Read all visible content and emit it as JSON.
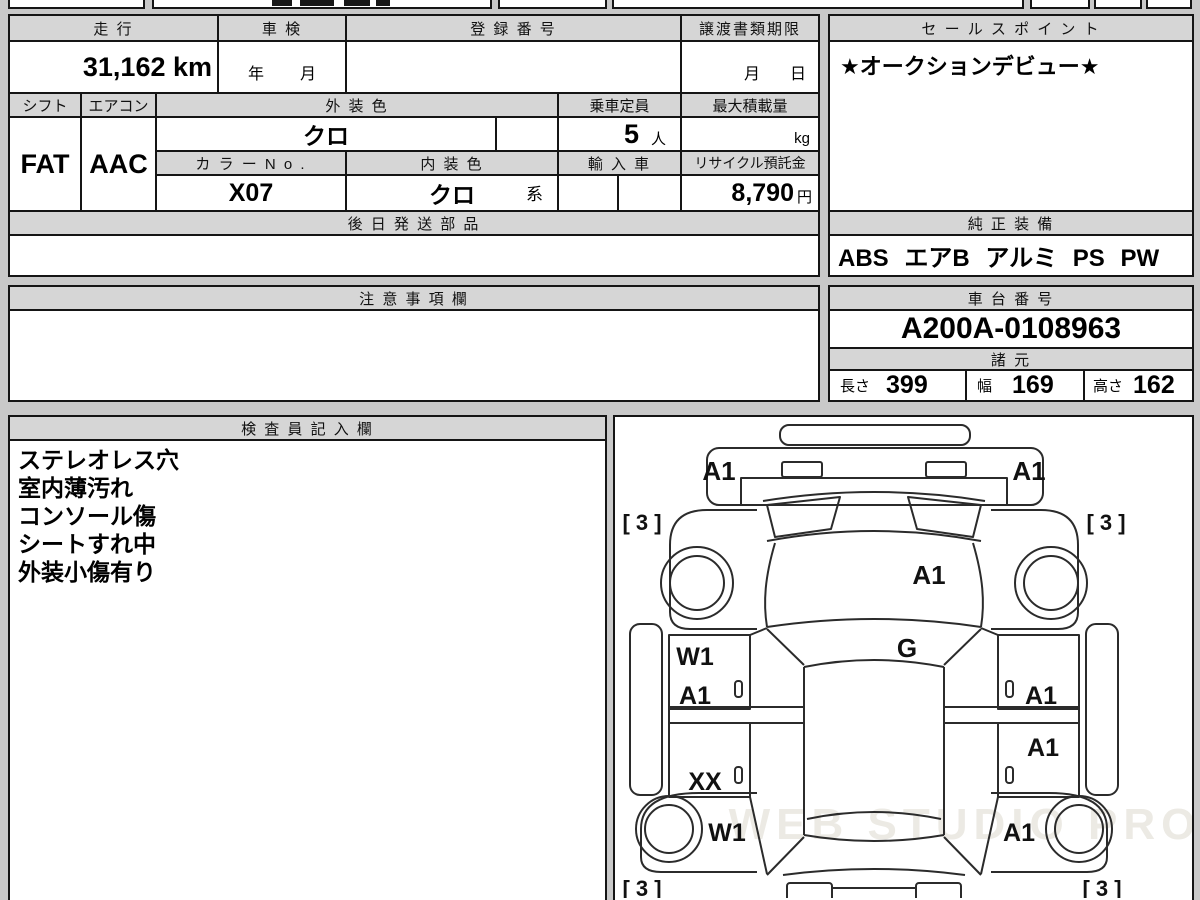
{
  "info_table": {
    "mileage": {
      "label": "走 行",
      "value": "31,162 km"
    },
    "inspection": {
      "label": "車 検",
      "year_label": "年",
      "month_label": "月"
    },
    "registration": {
      "label": "登 録 番 号",
      "value": ""
    },
    "transfer_deadline": {
      "label": "譲渡書類期限",
      "month_label": "月",
      "day_label": "日"
    },
    "shift": {
      "label": "シフト",
      "value": "FAT"
    },
    "aircon": {
      "label": "エアコン",
      "value": "AAC"
    },
    "exterior_color": {
      "label": "外 装 色",
      "value": "クロ"
    },
    "capacity": {
      "label": "乗車定員",
      "value": "5",
      "unit": "人"
    },
    "max_load": {
      "label": "最大積載量",
      "unit": "kg"
    },
    "color_no": {
      "label": "カ ラ ー N o .",
      "value": "X07"
    },
    "interior_color": {
      "label": "内 装 色",
      "value": "クロ",
      "suffix": "系"
    },
    "import_car": {
      "label": "輸 入 車"
    },
    "recycle_deposit": {
      "label": "リサイクル預託金",
      "value": "8,790",
      "unit": "円"
    },
    "later_parts": {
      "label": "後 日 発 送 部 品",
      "value": ""
    }
  },
  "sales_point": {
    "label": "セ ー ル ス ポ イ ン ト",
    "value": "★オークションデビュー★"
  },
  "equipment": {
    "label": "純 正 装 備",
    "value": "ABS エアB アルミ PS PW"
  },
  "caution": {
    "label": "注 意 事 項 欄",
    "value": ""
  },
  "chassis": {
    "label": "車 台 番 号",
    "value": "A200A-0108963"
  },
  "specs": {
    "label": "諸 元",
    "length_label": "長さ",
    "length": "399",
    "width_label": "幅",
    "width": "169",
    "height_label": "高さ",
    "height": "162"
  },
  "inspector": {
    "label": "検 査 員 記 入 欄",
    "items": [
      "ステレオレス穴",
      "室内薄汚れ",
      "コンソール傷",
      "シートすれ中",
      "外装小傷有り"
    ]
  },
  "diagram": {
    "watermark": "WEB STUDIO PRO",
    "marks": {
      "front_bumper_left": "A1",
      "front_bumper_right": "A1",
      "tire_front_left": "[ 3 ]",
      "tire_front_right": "[ 3 ]",
      "hood": "A1",
      "cowl": "G",
      "front_door_left_upper": "W1",
      "front_door_left_lower": "A1",
      "rear_door_left": "XX",
      "front_door_right": "A1",
      "rear_door_right": "A1",
      "rear_fender_left": "W1",
      "rear_fender_right": "A1",
      "tire_rear_left": "[ 3 ]",
      "tire_rear_right": "[ 3 ]"
    }
  },
  "colors": {
    "header_bg": "#d6d6d6",
    "border": "#151515",
    "page_bg": "#c9c9c9"
  }
}
